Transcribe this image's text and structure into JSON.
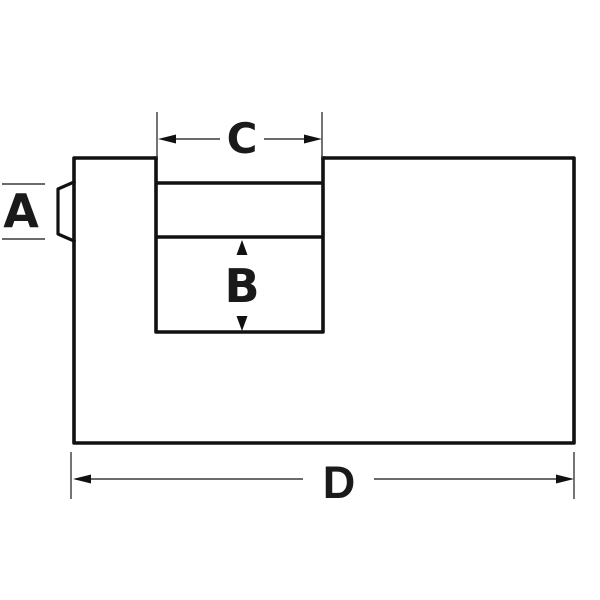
{
  "colors": {
    "background": "#ffffff",
    "outline": "#111111",
    "dimension_line": "#3a3a3a",
    "arrowhead": "#111111",
    "label_text": "#1a1a1a"
  },
  "dimension_labels": {
    "a": "A",
    "b": "B",
    "c": "C",
    "d": "D"
  }
}
